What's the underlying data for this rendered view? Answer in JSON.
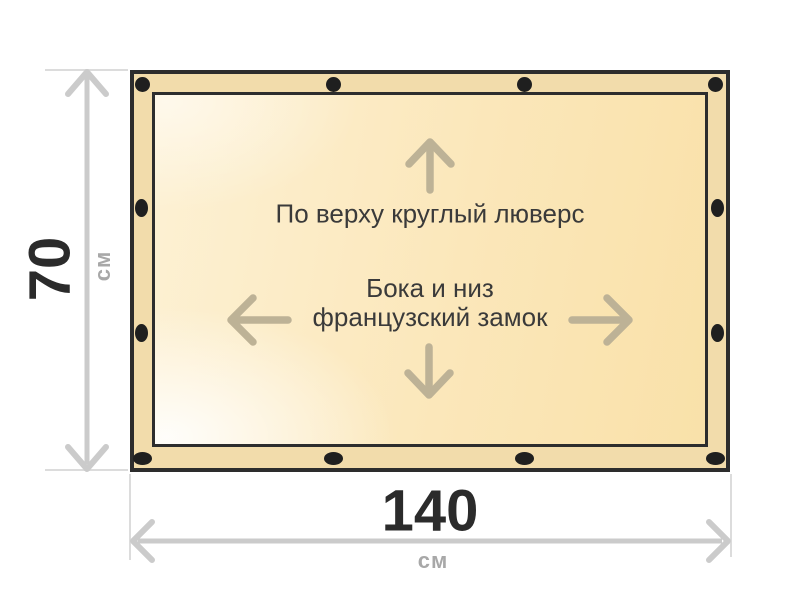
{
  "diagram": {
    "panel": {
      "top_note": "По верху круглый люверс",
      "center_note_line1": "Бока и низ",
      "center_note_line2": "французский замок"
    },
    "dimensions": {
      "height": {
        "value": "70",
        "unit": "см"
      },
      "width": {
        "value": "140",
        "unit": "см"
      }
    },
    "colors": {
      "panel_band": "#f2dcab",
      "panel_border": "#2d2d2d",
      "panel_fill_light": "#fffdf6",
      "panel_fill_dark": "#f9e1a9",
      "grommet": "#1f1f1f",
      "direction_arrow": "#bdb296",
      "dimension_line": "#cbcbcb",
      "extension_line": "#dcdcdc",
      "dimension_value_text": "#2b2b2b",
      "unit_text": "#a8a8a8",
      "note_text": "#3a3a3a"
    }
  }
}
